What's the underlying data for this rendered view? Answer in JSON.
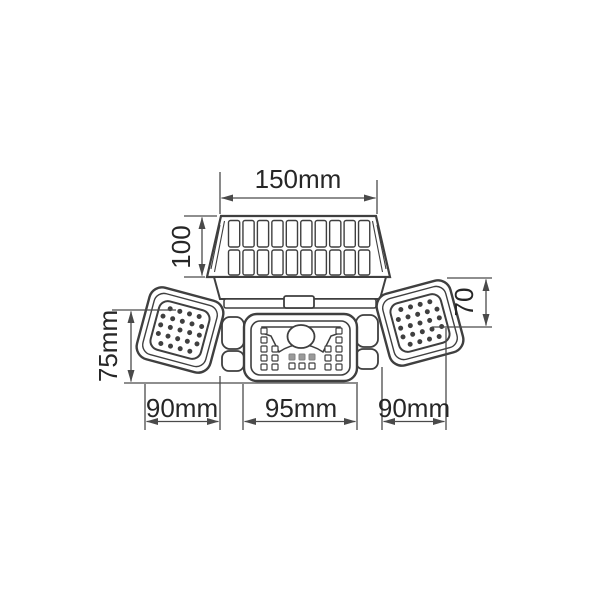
{
  "drawing": {
    "colors": {
      "line": "#3f3f3f",
      "dim_line": "#4a4a4a",
      "text": "#262626",
      "shaded_led": "#9a9a9a",
      "background": "#ffffff"
    },
    "labels": {
      "solar_panel_width": "150mm",
      "solar_panel_height": "100",
      "left_lamp_height": "75mm",
      "right_lamp_height": "70",
      "bottom_left_width": "90mm",
      "bottom_center_width": "95mm",
      "bottom_right_width": "90mm"
    },
    "components": {
      "solar_panel": {
        "cell_columns": 10,
        "cell_rows": 2
      },
      "side_lamps": {
        "led_rows": [
          4,
          5,
          5,
          5,
          4
        ]
      },
      "center_lamp": {
        "outer_led_column": 5,
        "inner_led_column": 3,
        "shaded_center_leds": 3,
        "bottom_center_leds": 3,
        "pir_sensor": true
      }
    }
  }
}
